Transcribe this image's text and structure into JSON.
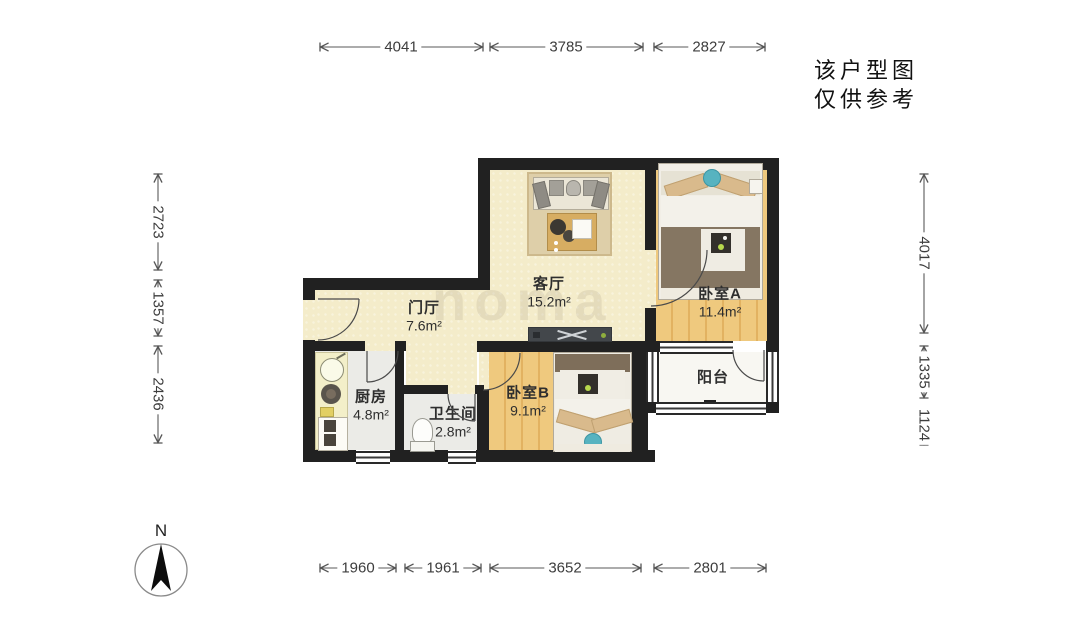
{
  "note": {
    "line1": "该户型图",
    "line2": "仅供参考"
  },
  "compass": {
    "label": "N"
  },
  "watermark": {
    "text": "noma"
  },
  "rooms": [
    {
      "id": "living-room",
      "name": "客厅",
      "area": "15.2m²"
    },
    {
      "id": "entry-hall",
      "name": "门厅",
      "area": "7.6m²"
    },
    {
      "id": "bedroom-a",
      "name": "卧室A",
      "area": "11.4m²"
    },
    {
      "id": "bedroom-b",
      "name": "卧室B",
      "area": "9.1m²"
    },
    {
      "id": "kitchen",
      "name": "厨房",
      "area": "4.8m²"
    },
    {
      "id": "bathroom",
      "name": "卫生间",
      "area": "2.8m²"
    },
    {
      "id": "balcony",
      "name": "阳台",
      "area": ""
    }
  ],
  "dimensions": {
    "top": [
      "4041",
      "3785",
      "2827"
    ],
    "bottom": [
      "1960",
      "1961",
      "3652",
      "2801"
    ],
    "left": [
      "2723",
      "1357",
      "2436"
    ],
    "right": [
      "4017",
      "1335",
      "1124"
    ]
  },
  "colors": {
    "wall": "#212121",
    "floor_wood": "#efc97e",
    "floor_cream": "#f4ecca",
    "floor_tile": "#ebebe7",
    "rug": "#decfa9",
    "accent_teal": "#57b3c0",
    "dim_line": "#555555"
  }
}
